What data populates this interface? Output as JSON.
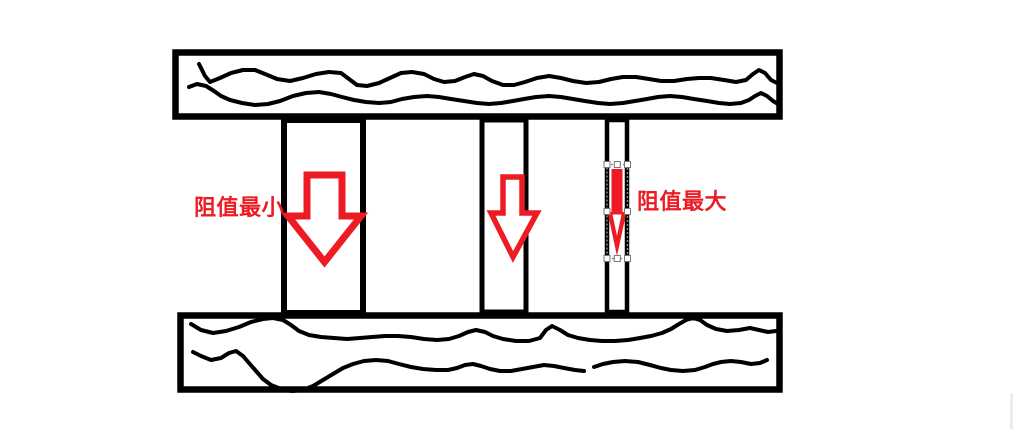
{
  "canvas": {
    "width": 1013,
    "height": 429,
    "background": "#ffffff"
  },
  "labels": {
    "min_resistance": "阻值最小",
    "max_resistance": "阻值最大"
  },
  "colors": {
    "ink": "#000000",
    "red": "#ed1c24",
    "white": "#ffffff",
    "selection_dash": "#8c8c8c",
    "handle_fill": "#ffffff",
    "handle_border": "#777777",
    "right_edge_artifact": "#ededed"
  },
  "diagram": {
    "kind": "hand-drawn resistance comparison: two hatched plates joined by three conductors of different widths",
    "conductors": [
      {
        "name": "wide-conductor",
        "arrow": "large outlined down arrow",
        "caption": "阻值最小"
      },
      {
        "name": "medium-conductor",
        "arrow": "medium outlined down arrow",
        "caption": ""
      },
      {
        "name": "narrow-conductor",
        "arrow": "thin filled down arrow, selected with handles",
        "caption": "阻值最大"
      }
    ]
  }
}
